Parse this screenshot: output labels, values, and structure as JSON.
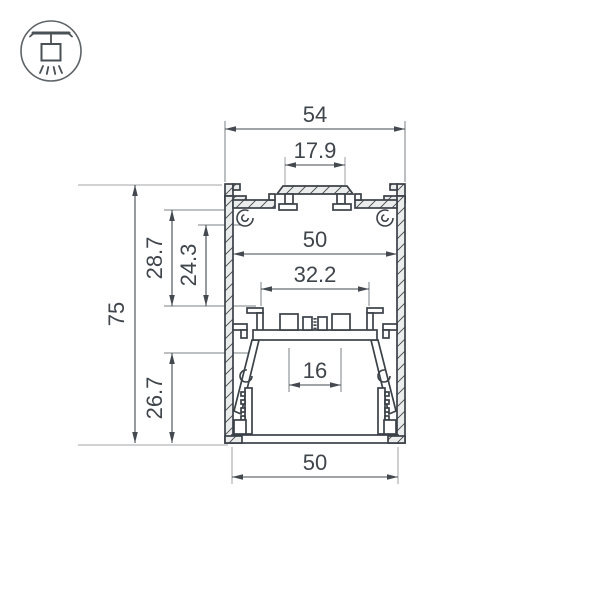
{
  "drawing": {
    "kind": "aluminium-led-profile-cross-section",
    "units": "mm",
    "dimensions": {
      "outer_width": "54",
      "top_platform_width": "17.9",
      "inner_width": "50",
      "shelf_width": "32.2",
      "screw_pitch": "16",
      "bottom_width": "50",
      "overall_height": "75",
      "upper_cavity_depth": "28.7",
      "boss_depth": "24.3",
      "lower_cavity_depth": "26.7"
    },
    "colors": {
      "outline": "#3a4147",
      "dimension_line": "#43494f",
      "extension_line": "#b3b6b9",
      "material_fill": "#ebecec",
      "background": "#ffffff"
    },
    "icon": {
      "name": "pendant-ceiling-mount",
      "meaning": "surface/pendant mounted luminaire"
    }
  }
}
